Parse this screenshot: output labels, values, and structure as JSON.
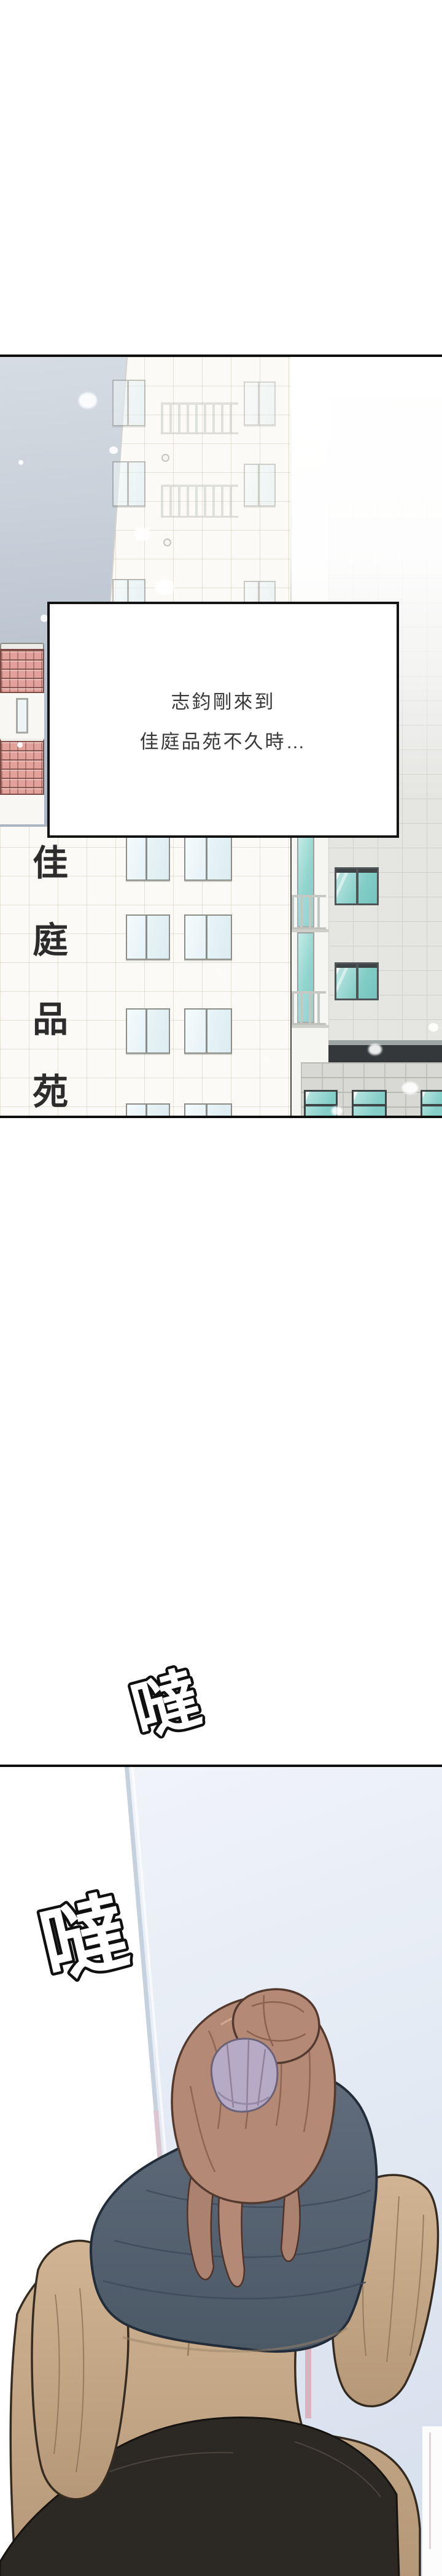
{
  "panel_building": {
    "narration_lines": [
      "志鈞剛來到",
      "佳庭品苑不久時…"
    ],
    "building_sign_text": "佳庭品苑",
    "building_sign_chars": [
      "佳",
      "庭",
      "品",
      "苑"
    ]
  },
  "sfx": {
    "footstep_1": "噠",
    "footstep_2": "噠"
  },
  "colors": {
    "panel_border": "#0e0e0e",
    "sky_top": "#d6dce3",
    "sky_bottom": "#a9b4c2",
    "white_wall": "#fbfaf7",
    "grey_wall": "#e5e5e2",
    "window_teal": "#8fd2cd",
    "window_pale": "#e9f5f7",
    "roof_tile_pink": "#e2a29b",
    "storefront_band": "#34383a",
    "narration_text": "#3a3a3a",
    "hall_wall_blue": "#dfe7f2",
    "edge_line_blue": "#c6d1de",
    "edge_line_pink": "#dcc6d2",
    "hair_auburn": "#b48a76",
    "scrunchie_lavender": "#b5abc6",
    "vest_slate": "#5b6776",
    "coat_tan": "#c9ad8e",
    "pants_dark": "#2c2824"
  }
}
